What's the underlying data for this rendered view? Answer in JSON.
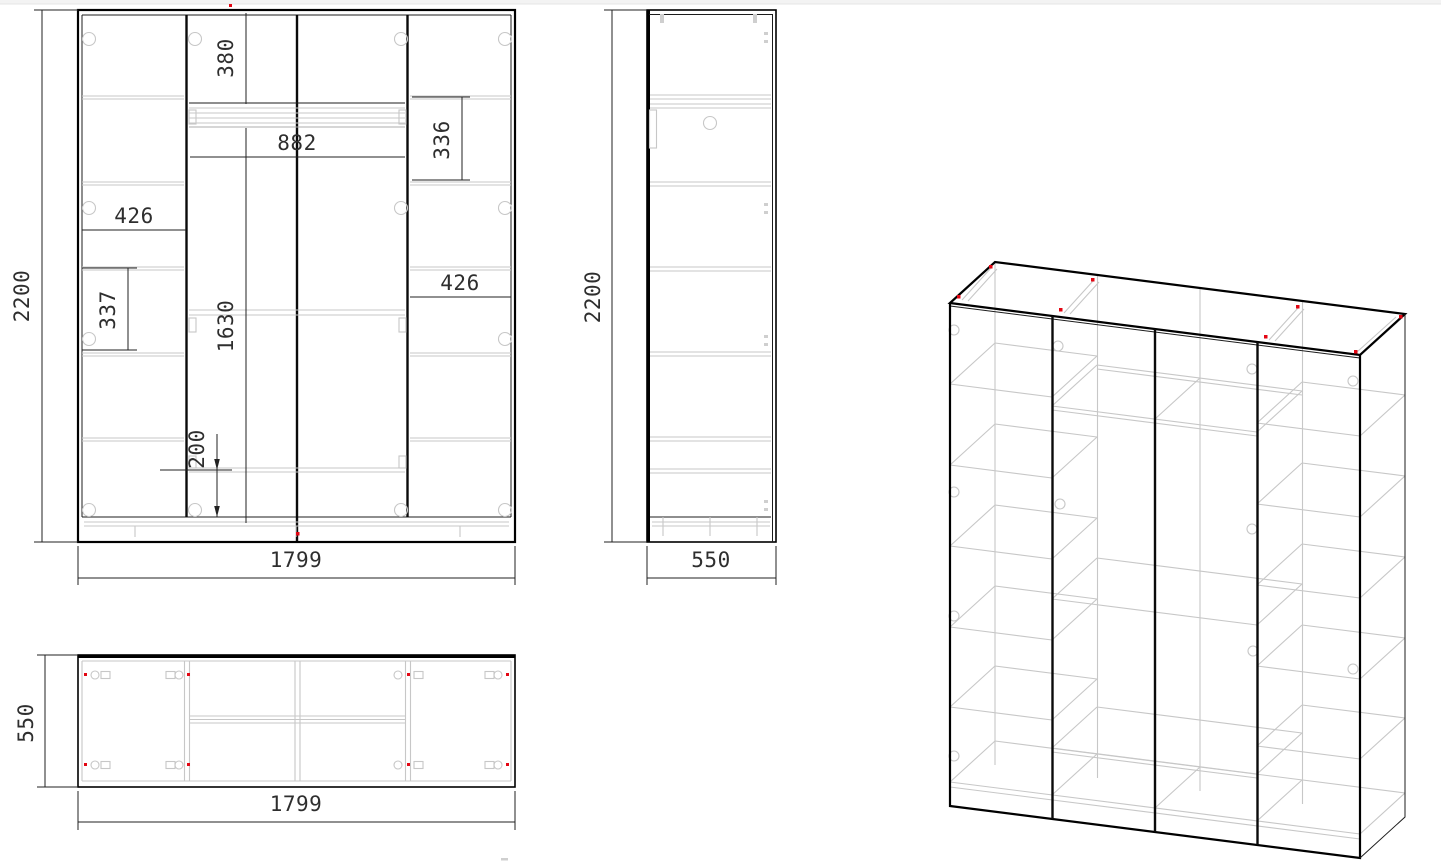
{
  "views": {
    "front": {
      "dimensions": {
        "overall_height": "2200",
        "overall_width": "1799",
        "top_section_height": "380",
        "center_span_width": "882",
        "right_upper_section_height": "336",
        "left_shelf_width": "426",
        "right_shelf_width": "426",
        "left_section_height": "337",
        "center_inner_height": "1630",
        "bottom_section_height": "200"
      }
    },
    "side": {
      "dimensions": {
        "overall_height": "2200",
        "overall_depth": "550"
      }
    },
    "top": {
      "dimensions": {
        "overall_depth": "550",
        "overall_width": "1799"
      }
    }
  },
  "colors": {
    "outline": "#000000",
    "internal_lines": "#c7c7c7",
    "fitting_marker_red": "#e30613",
    "dimension_text": "#2e2e2e",
    "canvas": "#ffffff"
  }
}
